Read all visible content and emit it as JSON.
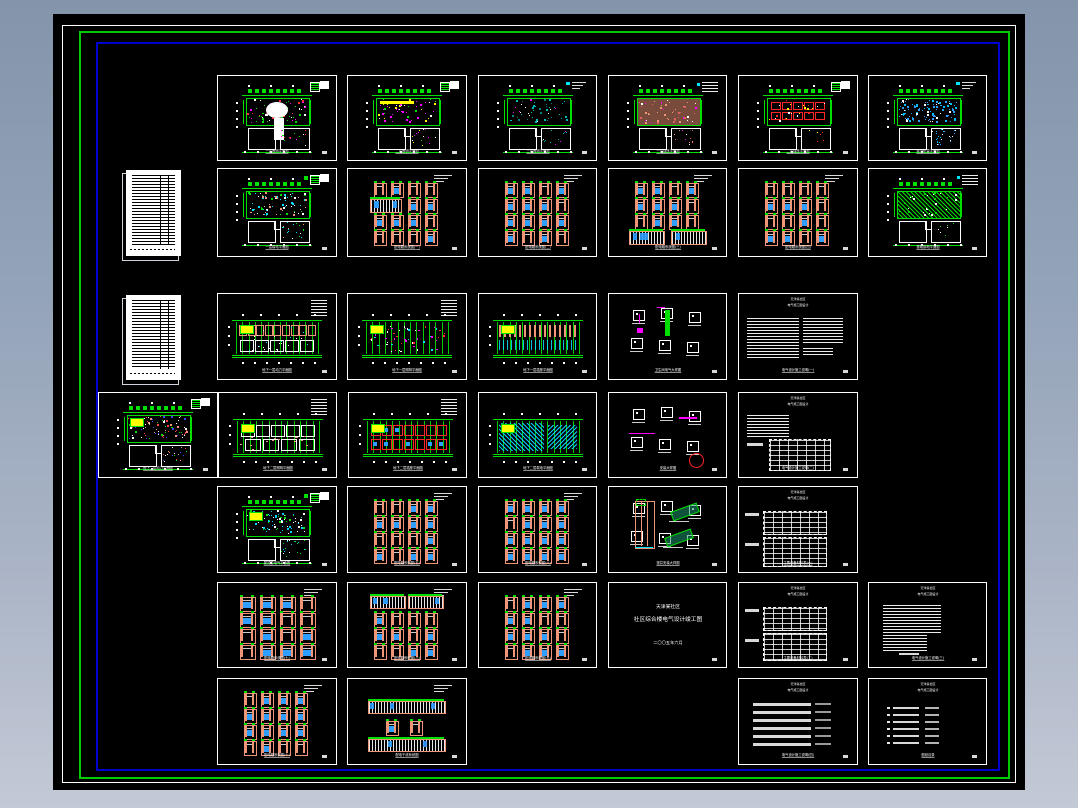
{
  "app": {
    "name": "cad-sheet-set-viewer",
    "description": "CAD model space showing a set of electrical construction drawing sheets"
  },
  "colors": {
    "bg_top": "#8495ab",
    "bg_bottom": "#c2c8d6",
    "canvas": "#000000",
    "border_white": "#ffffff",
    "border_green": "#00cc00",
    "border_blue": "#0000cc",
    "sheet_border": "#ffffff",
    "green": "#00e000",
    "salmon": "#ef9678",
    "blue": "#2e9fff",
    "cyan": "#00e5ff",
    "teal": "#00b8b8",
    "magenta": "#ff00ff",
    "red": "#ff2626",
    "yellow": "#ffff00",
    "white": "#ffffff"
  },
  "cover": {
    "line1": "天津某社区",
    "line2": "社区综合楼电气设计竣工图",
    "line3": "二〇〇五年六月"
  },
  "sheet_header": {
    "line1": "天津某社区",
    "line2": "电气施工图设计"
  },
  "docs": [
    {
      "id": "doc-list-1",
      "x": 126,
      "y": 170,
      "w": 55,
      "h": 86
    },
    {
      "id": "doc-list-2",
      "x": 126,
      "y": 295,
      "w": 55,
      "h": 85
    }
  ],
  "variants": {
    "p_green": {
      "dots": [
        "#00e000",
        "#00e000",
        "#ffffff",
        "#ff3030",
        "#ff00ff"
      ],
      "n": 70,
      "blob": true,
      "corner": "blocks"
    },
    "p_magenta": {
      "dots": [
        "#ff00ff",
        "#ff00ff",
        "#ffffff",
        "#00e000",
        "#ffff00"
      ],
      "n": 60,
      "strip": true,
      "corner": "blocks"
    },
    "p_teal": {
      "dots": [
        "#00b8b8",
        "#00b8b8",
        "#ffffff",
        "#ff00ff",
        "#008080"
      ],
      "n": 55,
      "corner": "cyantext"
    },
    "p_salmon": {
      "dots": [
        "#ef9678",
        "#ffffff",
        "#ff00ff",
        "#e06060"
      ],
      "n": 55,
      "fillband": true,
      "corner": "textblock"
    },
    "p_redgrid": {
      "dots": [
        "#ffff00",
        "#ffffff",
        "#ff2626"
      ],
      "n": 25,
      "boxes": true,
      "corner": "blocks"
    },
    "p_cyandense": {
      "dots": [
        "#2e9fff",
        "#2e9fff",
        "#00bfff",
        "#ffffff"
      ],
      "n": 110,
      "corner": "cyantext"
    },
    "p_greencyan": {
      "dots": [
        "#00e000",
        "#00e5ff",
        "#ffffff",
        "#ef9678"
      ],
      "n": 80,
      "corner": "blocks2"
    },
    "p_greenhatch": {
      "dots": [
        "#00e000",
        "#ffffff"
      ],
      "n": 30,
      "hatch": true,
      "corner": "textblock"
    },
    "p_dense": {
      "dots": [
        "#ffffff",
        "#ff4040",
        "#4040ff",
        "#ef9678",
        "#00e000"
      ],
      "n": 90,
      "yellow": true,
      "corner": "blocks"
    },
    "p_cyanscatter": {
      "dots": [
        "#00cfff",
        "#ffffff",
        "#00e000"
      ],
      "n": 90,
      "yellow": true,
      "corner": "blocks2"
    },
    "w_salmon": {
      "mode": "rooms",
      "yellow": true,
      "legend": true
    },
    "w_red": {
      "mode": "reddots",
      "yellow": true,
      "legend": true
    },
    "w_stripes": {
      "mode": "stripes",
      "yellow": true,
      "legend": false
    },
    "w_light": {
      "mode": "light",
      "yellow": true,
      "legend": true
    },
    "w_redgrid": {
      "mode": "redgrid",
      "yellow": true,
      "legend": true
    },
    "w_cyanhatch": {
      "mode": "cyanhatch",
      "yellow": true,
      "legend": false
    },
    "g_plain": {
      "layout": "plain"
    },
    "g_wide": {
      "layout": "wide"
    },
    "g_wideTop": {
      "layout": "wideTop"
    },
    "g_wideMid": {
      "layout": "wideMid"
    },
    "g_wideBottom": {
      "layout": "wideBottom"
    },
    "g_bands": {
      "layout": "bands"
    },
    "d_riser": {
      "mode": "riser"
    },
    "d_circle": {
      "mode": "circle"
    },
    "d_shaft": {
      "mode": "shaft"
    },
    "t_twocol": {
      "mode": "twocol"
    },
    "t_table": {
      "mode": "table"
    },
    "t_blob": {
      "mode": "blob"
    },
    "t_blob2": {
      "mode": "blob2"
    },
    "tb_a": {
      "mode": "a"
    },
    "tb_b": {
      "mode": "b"
    }
  },
  "sheets": [
    {
      "id": "r1c1",
      "kind": "plan",
      "variant": "p_green",
      "x": 217,
      "y": 75,
      "w": 118,
      "h": 84,
      "title": "一层照明平面图"
    },
    {
      "id": "r1c2",
      "kind": "plan",
      "variant": "p_magenta",
      "x": 347,
      "y": 75,
      "w": 118,
      "h": 84,
      "title": "二层照明平面图"
    },
    {
      "id": "r1c3",
      "kind": "plan",
      "variant": "p_teal",
      "x": 478,
      "y": 75,
      "w": 117,
      "h": 84,
      "title": "三层照明平面图"
    },
    {
      "id": "r1c4",
      "kind": "plan",
      "variant": "p_salmon",
      "x": 608,
      "y": 75,
      "w": 117,
      "h": 84,
      "title": "一层插座平面图"
    },
    {
      "id": "r1c5",
      "kind": "plan",
      "variant": "p_redgrid",
      "x": 738,
      "y": 75,
      "w": 118,
      "h": 84,
      "title": "二层插座平面图"
    },
    {
      "id": "r1c6",
      "kind": "plan",
      "variant": "p_cyandense",
      "x": 868,
      "y": 75,
      "w": 117,
      "h": 84,
      "title": "屋顶防雷平面图"
    },
    {
      "id": "r2c1",
      "kind": "plan",
      "variant": "p_greencyan",
      "x": 217,
      "y": 168,
      "w": 118,
      "h": 87,
      "title": "一层弱电平面图"
    },
    {
      "id": "r2c2",
      "kind": "panelgrid",
      "variant": "g_wideMid",
      "x": 347,
      "y": 168,
      "w": 118,
      "h": 87,
      "title": "配电箱系统图(一)"
    },
    {
      "id": "r2c3",
      "kind": "panelgrid",
      "variant": "g_plain",
      "x": 478,
      "y": 168,
      "w": 117,
      "h": 87,
      "title": "配电箱系统图(二)"
    },
    {
      "id": "r2c4",
      "kind": "panelgrid",
      "variant": "g_wideBottom",
      "x": 608,
      "y": 168,
      "w": 117,
      "h": 87,
      "title": "配电箱系统图(三)"
    },
    {
      "id": "r2c5",
      "kind": "panelgrid",
      "variant": "g_plain",
      "x": 738,
      "y": 168,
      "w": 118,
      "h": 87,
      "title": "配电箱系统图(四)"
    },
    {
      "id": "r2c6",
      "kind": "plan",
      "variant": "p_greenhatch",
      "x": 868,
      "y": 168,
      "w": 117,
      "h": 87,
      "title": "基础接地平面图"
    },
    {
      "id": "r3c1",
      "kind": "wideplan",
      "variant": "w_salmon",
      "x": 217,
      "y": 293,
      "w": 118,
      "h": 85,
      "title": "地下一层动力平面图"
    },
    {
      "id": "r3c2",
      "kind": "wideplan",
      "variant": "w_red",
      "x": 347,
      "y": 293,
      "w": 118,
      "h": 85,
      "title": "地下一层照明平面图"
    },
    {
      "id": "r3c3",
      "kind": "wideplan",
      "variant": "w_stripes",
      "x": 478,
      "y": 293,
      "w": 117,
      "h": 85,
      "title": "地下一层插座平面图"
    },
    {
      "id": "r3c4",
      "kind": "details",
      "variant": "d_riser",
      "x": 608,
      "y": 293,
      "w": 117,
      "h": 85,
      "title": "卫生间电气大样图"
    },
    {
      "id": "r3c5",
      "kind": "textsheet",
      "variant": "t_twocol",
      "x": 738,
      "y": 293,
      "w": 118,
      "h": 85,
      "title": "电气设计施工说明(一)"
    },
    {
      "id": "r4c0",
      "kind": "plan",
      "variant": "p_dense",
      "x": 98,
      "y": 392,
      "w": 118,
      "h": 84,
      "title": "地下二层动力平面图"
    },
    {
      "id": "r4c1",
      "kind": "wideplan",
      "variant": "w_light",
      "x": 218,
      "y": 392,
      "w": 117,
      "h": 84,
      "title": "地下二层照明平面图"
    },
    {
      "id": "r4c2",
      "kind": "wideplan",
      "variant": "w_redgrid",
      "x": 348,
      "y": 392,
      "w": 117,
      "h": 84,
      "title": "地下二层插座平面图"
    },
    {
      "id": "r4c3",
      "kind": "wideplan",
      "variant": "w_cyanhatch",
      "x": 478,
      "y": 392,
      "w": 117,
      "h": 84,
      "title": "地下二层弱电平面图"
    },
    {
      "id": "r4c4",
      "kind": "details",
      "variant": "d_circle",
      "x": 608,
      "y": 392,
      "w": 117,
      "h": 84,
      "title": "安装大样图"
    },
    {
      "id": "r4c5",
      "kind": "textsheet",
      "variant": "t_table",
      "x": 738,
      "y": 392,
      "w": 118,
      "h": 84,
      "title": "电气设计施工说明(二)"
    },
    {
      "id": "r5c1",
      "kind": "plan",
      "variant": "p_cyanscatter",
      "x": 217,
      "y": 486,
      "w": 118,
      "h": 85,
      "title": "屋顶层电气平面图"
    },
    {
      "id": "r5c2",
      "kind": "panelgrid",
      "variant": "g_plain",
      "x": 347,
      "y": 486,
      "w": 118,
      "h": 85,
      "title": "配电箱系统图(五)"
    },
    {
      "id": "r5c3",
      "kind": "panelgrid",
      "variant": "g_plain",
      "x": 478,
      "y": 486,
      "w": 117,
      "h": 85,
      "title": "配电箱系统图(六)"
    },
    {
      "id": "r5c4",
      "kind": "details",
      "variant": "d_shaft",
      "x": 608,
      "y": 486,
      "w": 117,
      "h": 85,
      "title": "竖井安装大样图"
    },
    {
      "id": "r5c5",
      "kind": "tablesheet",
      "variant": "tb_a",
      "x": 738,
      "y": 486,
      "w": 118,
      "h": 85,
      "title": "主要设备材料表(一)"
    },
    {
      "id": "r6c1",
      "kind": "panelgrid",
      "variant": "g_wide",
      "x": 217,
      "y": 582,
      "w": 118,
      "h": 84,
      "title": "配电箱系统图(七)"
    },
    {
      "id": "r6c2",
      "kind": "panelgrid",
      "variant": "g_wideTop",
      "x": 347,
      "y": 582,
      "w": 118,
      "h": 84,
      "title": "配电箱系统图(八)"
    },
    {
      "id": "r6c3",
      "kind": "panelgrid",
      "variant": "g_plain",
      "x": 478,
      "y": 582,
      "w": 117,
      "h": 84,
      "title": "配电箱系统图(九)"
    },
    {
      "id": "r6c4",
      "kind": "cover",
      "variant": "",
      "x": 608,
      "y": 582,
      "w": 117,
      "h": 84,
      "title": ""
    },
    {
      "id": "r6c5",
      "kind": "tablesheet",
      "variant": "tb_b",
      "x": 738,
      "y": 582,
      "w": 118,
      "h": 84,
      "title": "主要设备材料表(二)"
    },
    {
      "id": "r6c6",
      "kind": "textsheet",
      "variant": "t_blob",
      "x": 868,
      "y": 582,
      "w": 117,
      "h": 84,
      "title": "电气设计施工说明(三)"
    },
    {
      "id": "r7c1",
      "kind": "panelgrid",
      "variant": "g_plain",
      "x": 217,
      "y": 678,
      "w": 118,
      "h": 85,
      "title": "配电箱系统图(十)"
    },
    {
      "id": "r7c2",
      "kind": "panelgrid",
      "variant": "g_bands",
      "x": 347,
      "y": 678,
      "w": 118,
      "h": 85,
      "title": "配电干线系统图"
    },
    {
      "id": "r7c5",
      "kind": "textsheet",
      "variant": "t_blob2",
      "x": 738,
      "y": 678,
      "w": 118,
      "h": 85,
      "title": "电气设计施工说明(四)"
    },
    {
      "id": "r7c6",
      "kind": "listsheet",
      "variant": "",
      "x": 868,
      "y": 678,
      "w": 117,
      "h": 85,
      "title": "图纸目录"
    }
  ]
}
